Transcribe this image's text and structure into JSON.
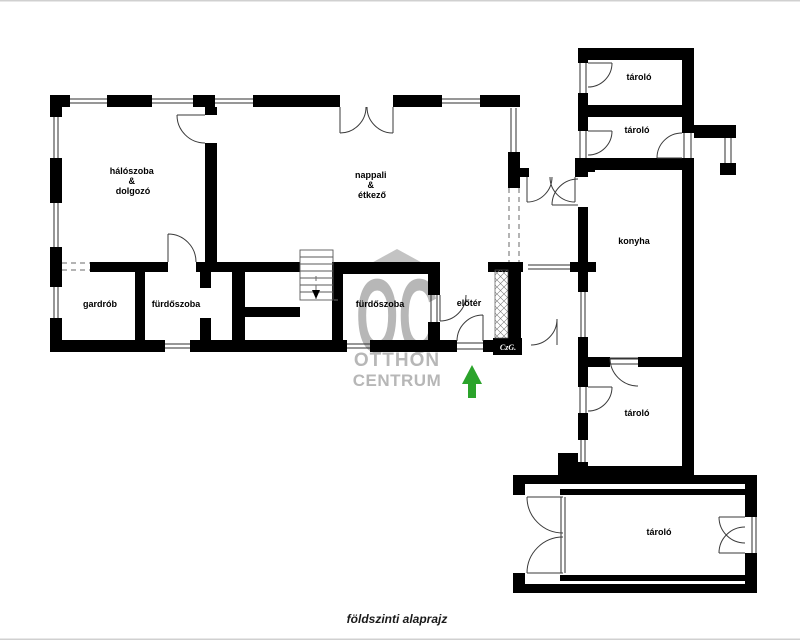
{
  "footer": {
    "caption": "földszinti alaprajz"
  },
  "watermark": {
    "monogram": "OC",
    "line1": "OTTHON",
    "line2": "CENTRUM"
  },
  "signature": "CzG.",
  "rooms": {
    "haloszoba": {
      "lines": [
        "hálószoba",
        "&",
        "dolgozó"
      ]
    },
    "nappali": {
      "lines": [
        "nappali",
        "&",
        "étkező"
      ]
    },
    "gardrob": {
      "label": "gardrób"
    },
    "furdoszoba1": {
      "label": "fürdőszoba"
    },
    "furdoszoba2": {
      "label": "fürdőszoba"
    },
    "eloter": {
      "label": "előtér"
    },
    "konyha": {
      "label": "konyha"
    },
    "tarolo1": {
      "label": "tároló"
    },
    "tarolo2": {
      "label": "tároló"
    },
    "tarolo3": {
      "label": "tároló"
    },
    "tarolo4": {
      "label": "tároló"
    }
  },
  "colors": {
    "wall": "#000000",
    "watermark_gray": "#b7b7b7",
    "arrow_green": "#2ba32b",
    "background": "#ffffff"
  }
}
